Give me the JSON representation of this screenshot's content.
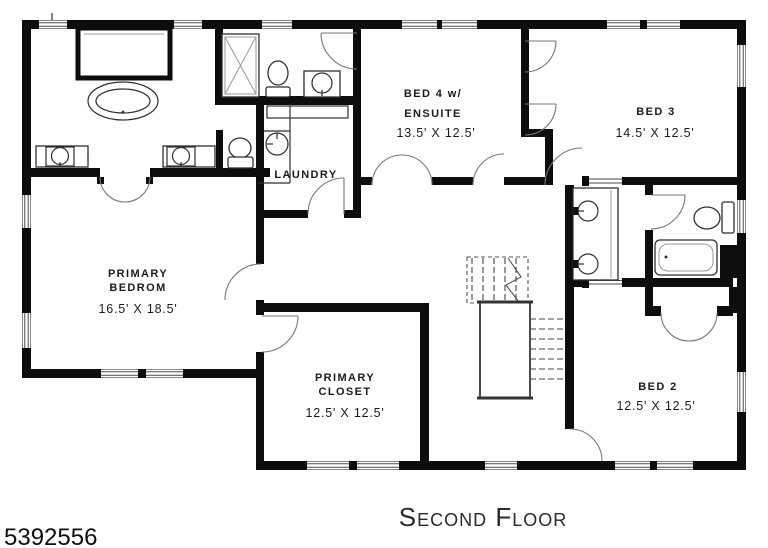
{
  "floorplan": {
    "caption": "Second Floor",
    "photo_id": "5392556",
    "rooms": [
      {
        "id": "bed-4",
        "name_line1": "BED 4 w/",
        "name_line2": "ENSUITE",
        "dimensions": "13.5' X 12.5'"
      },
      {
        "id": "bed-3",
        "name_line1": "BED 3",
        "dimensions": "14.5' X 12.5'"
      },
      {
        "id": "laundry",
        "name_line1": "LAUNDRY"
      },
      {
        "id": "primary-bedroom",
        "name_line1": "PRIMARY",
        "name_line2": "BEDROM",
        "dimensions": "16.5' X 18.5'"
      },
      {
        "id": "primary-closet",
        "name_line1": "PRIMARY",
        "name_line2": "CLOSET",
        "dimensions": "12.5' X 12.5'"
      },
      {
        "id": "bed-2",
        "name_line1": "BED 2",
        "dimensions": "12.5' X 12.5'"
      }
    ],
    "fixtures": [
      "built-in-wardrobe",
      "freestanding-oval-tub",
      "vanity-sink",
      "vanity-sink",
      "toilet",
      "walk-in-shower",
      "toilet",
      "vanity-sink",
      "laundry-counter",
      "laundry-sink",
      "double-vanity-sinks",
      "toilet",
      "alcove-tub",
      "staircase"
    ],
    "colors": {
      "walls": "#0d0d0d",
      "fixture_lines": "#2f2f2f",
      "door_arcs": "#777777",
      "label_text": "#1b1b1b",
      "background": "#ffffff"
    }
  }
}
